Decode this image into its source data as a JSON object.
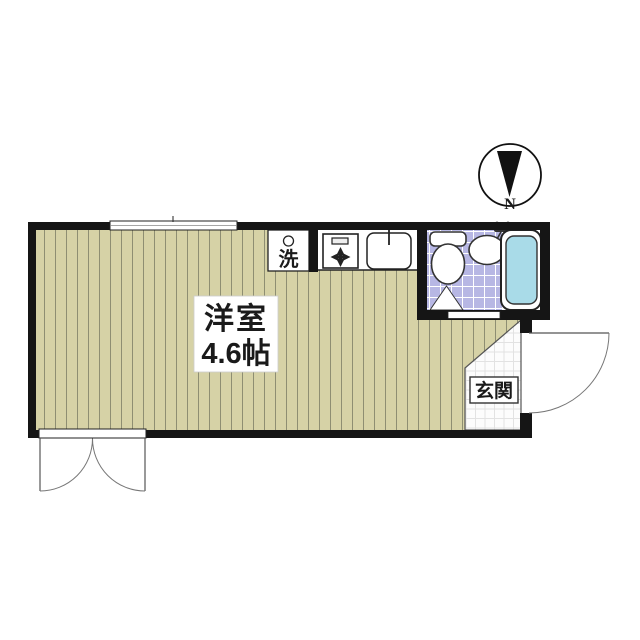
{
  "labels": {
    "room_name": "洋室",
    "room_size": "4.6帖",
    "entrance": "玄関",
    "laundry": "洗",
    "compass_north": "N"
  },
  "colors": {
    "wall": "#151515",
    "flooring": "#d6d2a6",
    "flooring_line": "#8e8e72",
    "bath_tile": "#b7b7e4",
    "bath_tile_line": "#ffffff",
    "tub_water": "#a9dbe8",
    "entrance_tile": "#fcfcfc",
    "entrance_tile_line": "#e2e2e2",
    "fixture_outline": "#333333"
  },
  "icons": {
    "compass": "north-compass-icon",
    "stove": "gas-stove-burner-icon",
    "kitchen_sink": "kitchen-sink-icon",
    "washer_hookup": "washing-machine-outlet-icon",
    "toilet": "toilet-icon",
    "wash_basin": "wash-basin-icon",
    "bathtub": "bathtub-icon",
    "door_swing": "door-swing-arc-icon"
  }
}
